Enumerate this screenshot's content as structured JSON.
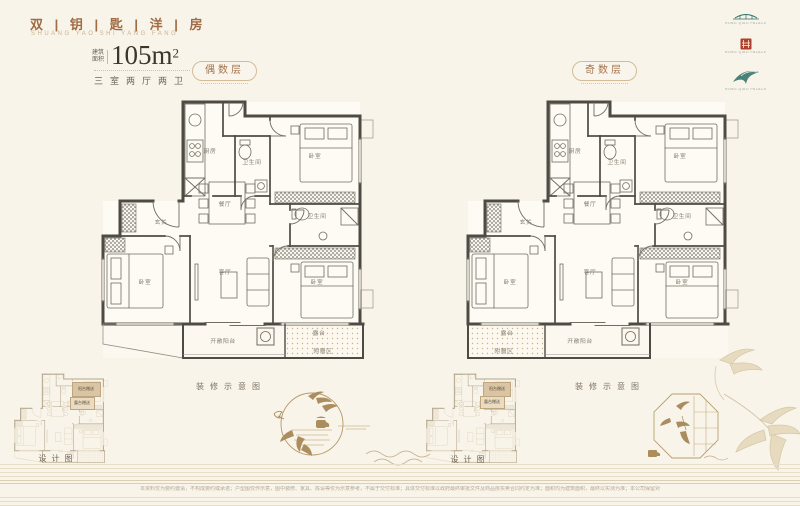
{
  "header": {
    "title": "双 | 钥 | 匙 | 洋 | 房",
    "subtitle": "SHUANG YAO SHI YANG FANG",
    "area_prefix_top": "建筑",
    "area_prefix_bottom": "面积",
    "area_value": "105m",
    "area_sup": "2",
    "spec": "三室两厅两卫"
  },
  "badges": {
    "even": "偶数层",
    "odd": "奇数层"
  },
  "rooms": {
    "kitchen": "厨房",
    "bath": "卫生间",
    "bedroom": "卧室",
    "dining": "餐厅",
    "foyer": "玄关",
    "living": "客厅",
    "balcony": "开敞阳台",
    "terrace": "露台",
    "bonus": "附赠区"
  },
  "captions": {
    "deco_label_left": "装修示意图",
    "deco_label_right": "装修示意图",
    "design_label_left": "设计图",
    "design_label_right": "设计图"
  },
  "thumbs": {
    "callout_top": "阳台赠送",
    "callout_bottom": "露台赠送"
  },
  "logos": [
    {
      "name": "bridge-seal",
      "caption": "HONG QIAO PALACE"
    },
    {
      "name": "red-seal",
      "caption": "HONG QIAO PALACE"
    },
    {
      "name": "phoenix-seal",
      "caption": "HONG QIAO PALACE"
    }
  ],
  "footer": {
    "disclaimer": "本资料仅为要约邀请，不构成要约或承诺；户型图仅作示意，图中装修、家具、陈设等仅为示意参考，不属于交付标准；具体交付标准以政府最终审批文件及商品房买卖合同约定为准；面积均为建筑面积，最终以实测为准；本公司保留对宣传资料的解释权与修改权，敬请留意最新资料。"
  }
}
